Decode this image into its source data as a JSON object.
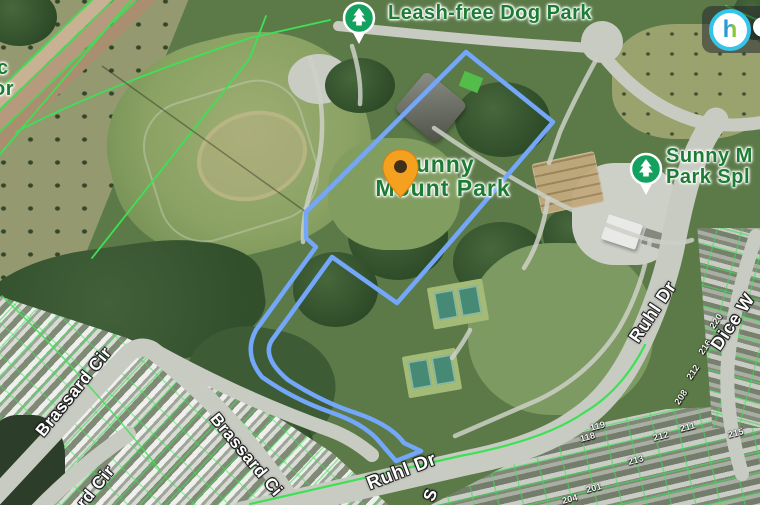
{
  "poi": {
    "dog_park": "Leash-free Dog Park",
    "park_l1": "Sunny",
    "park_l2": "Mount Park",
    "splash_l1": "Sunny M",
    "splash_l2": "Park Spl",
    "edge_l1": "c",
    "edge_l2": "or"
  },
  "streets": {
    "ruhl_bottom": "Ruhl Dr",
    "ruhl_right": "Ruhl Dr",
    "dice": "Dice W",
    "brassard_1": "Brassard Cir",
    "brassard_2": "Brassard Ci",
    "brassard_3": "rd Cir",
    "s_fragment": "S"
  },
  "house_numbers": [
    "220",
    "216",
    "212",
    "208",
    "119",
    "118",
    "211",
    "212",
    "213",
    "201",
    "215",
    "204"
  ],
  "logo": {
    "letter": "h"
  },
  "colors": {
    "parcel_boundary_blue": "#74a7f9",
    "cadastral_green": "#3ee055",
    "poi_label_green": "#1d7c33",
    "pin_orange": "#f5a01e",
    "tree_icon_green": "#12a15e",
    "road_gray": "#c8cbc2"
  }
}
